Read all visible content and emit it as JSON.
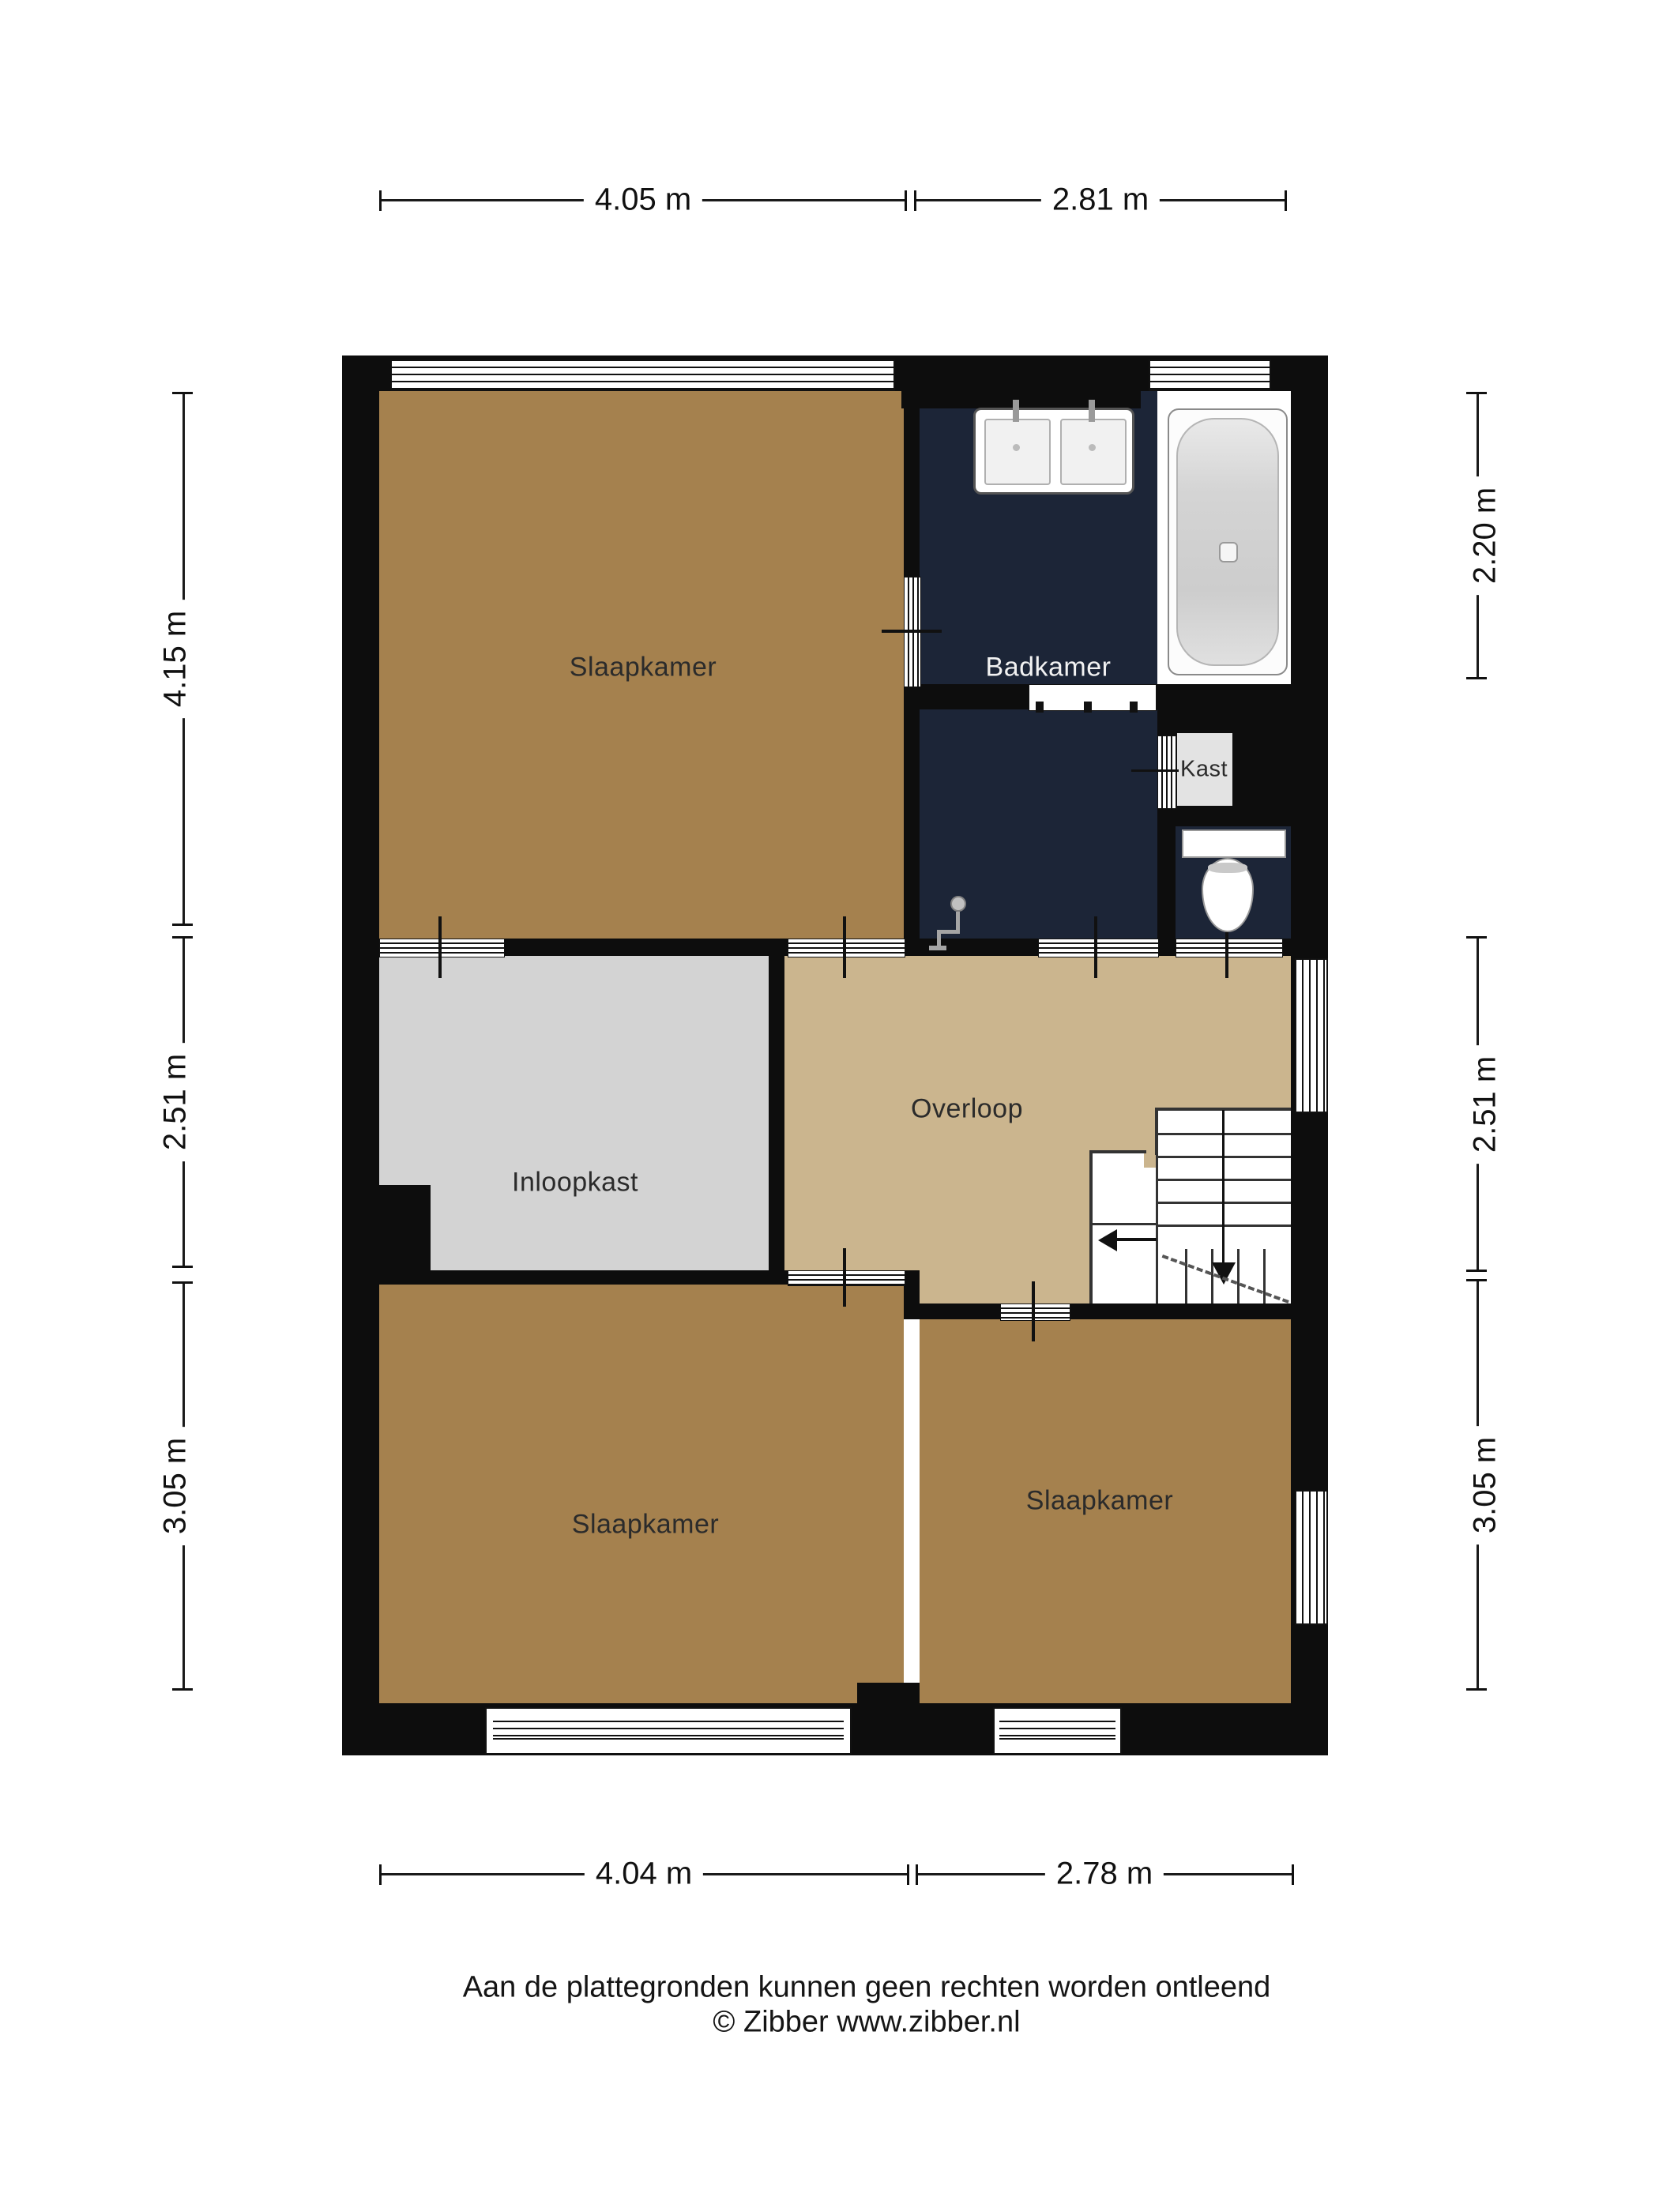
{
  "rooms": {
    "bedroom_top_left": {
      "label": "Slaapkamer"
    },
    "bathroom": {
      "label": "Badkamer"
    },
    "closet": {
      "label": "Kast"
    },
    "walk_in_closet": {
      "label": "Inloopkast"
    },
    "landing": {
      "label": "Overloop"
    },
    "bedroom_bottom_left": {
      "label": "Slaapkamer"
    },
    "bedroom_bottom_right": {
      "label": "Slaapkamer"
    }
  },
  "dimensions": {
    "top": {
      "left": "4.05 m",
      "right": "2.81 m"
    },
    "bottom": {
      "left": "4.04 m",
      "right": "2.78 m"
    },
    "left": {
      "top": "4.15 m",
      "middle": "2.51 m",
      "bottom": "3.05 m"
    },
    "right": {
      "top": "2.20 m",
      "middle": "2.51 m",
      "bottom": "3.05 m"
    }
  },
  "footer": {
    "disclaimer": "Aan de plattegronden kunnen geen rechten worden ontleend",
    "copyright": "© Zibber www.zibber.nl"
  },
  "colors": {
    "wall": "#0D0D0D",
    "bedroom_floor": "#A5814E",
    "landing_floor": "#CBB58E",
    "walk_in_closet_floor": "#D3D3D3",
    "bathroom_floor": "#1C2537",
    "closet_fill": "#E3E3E3"
  }
}
